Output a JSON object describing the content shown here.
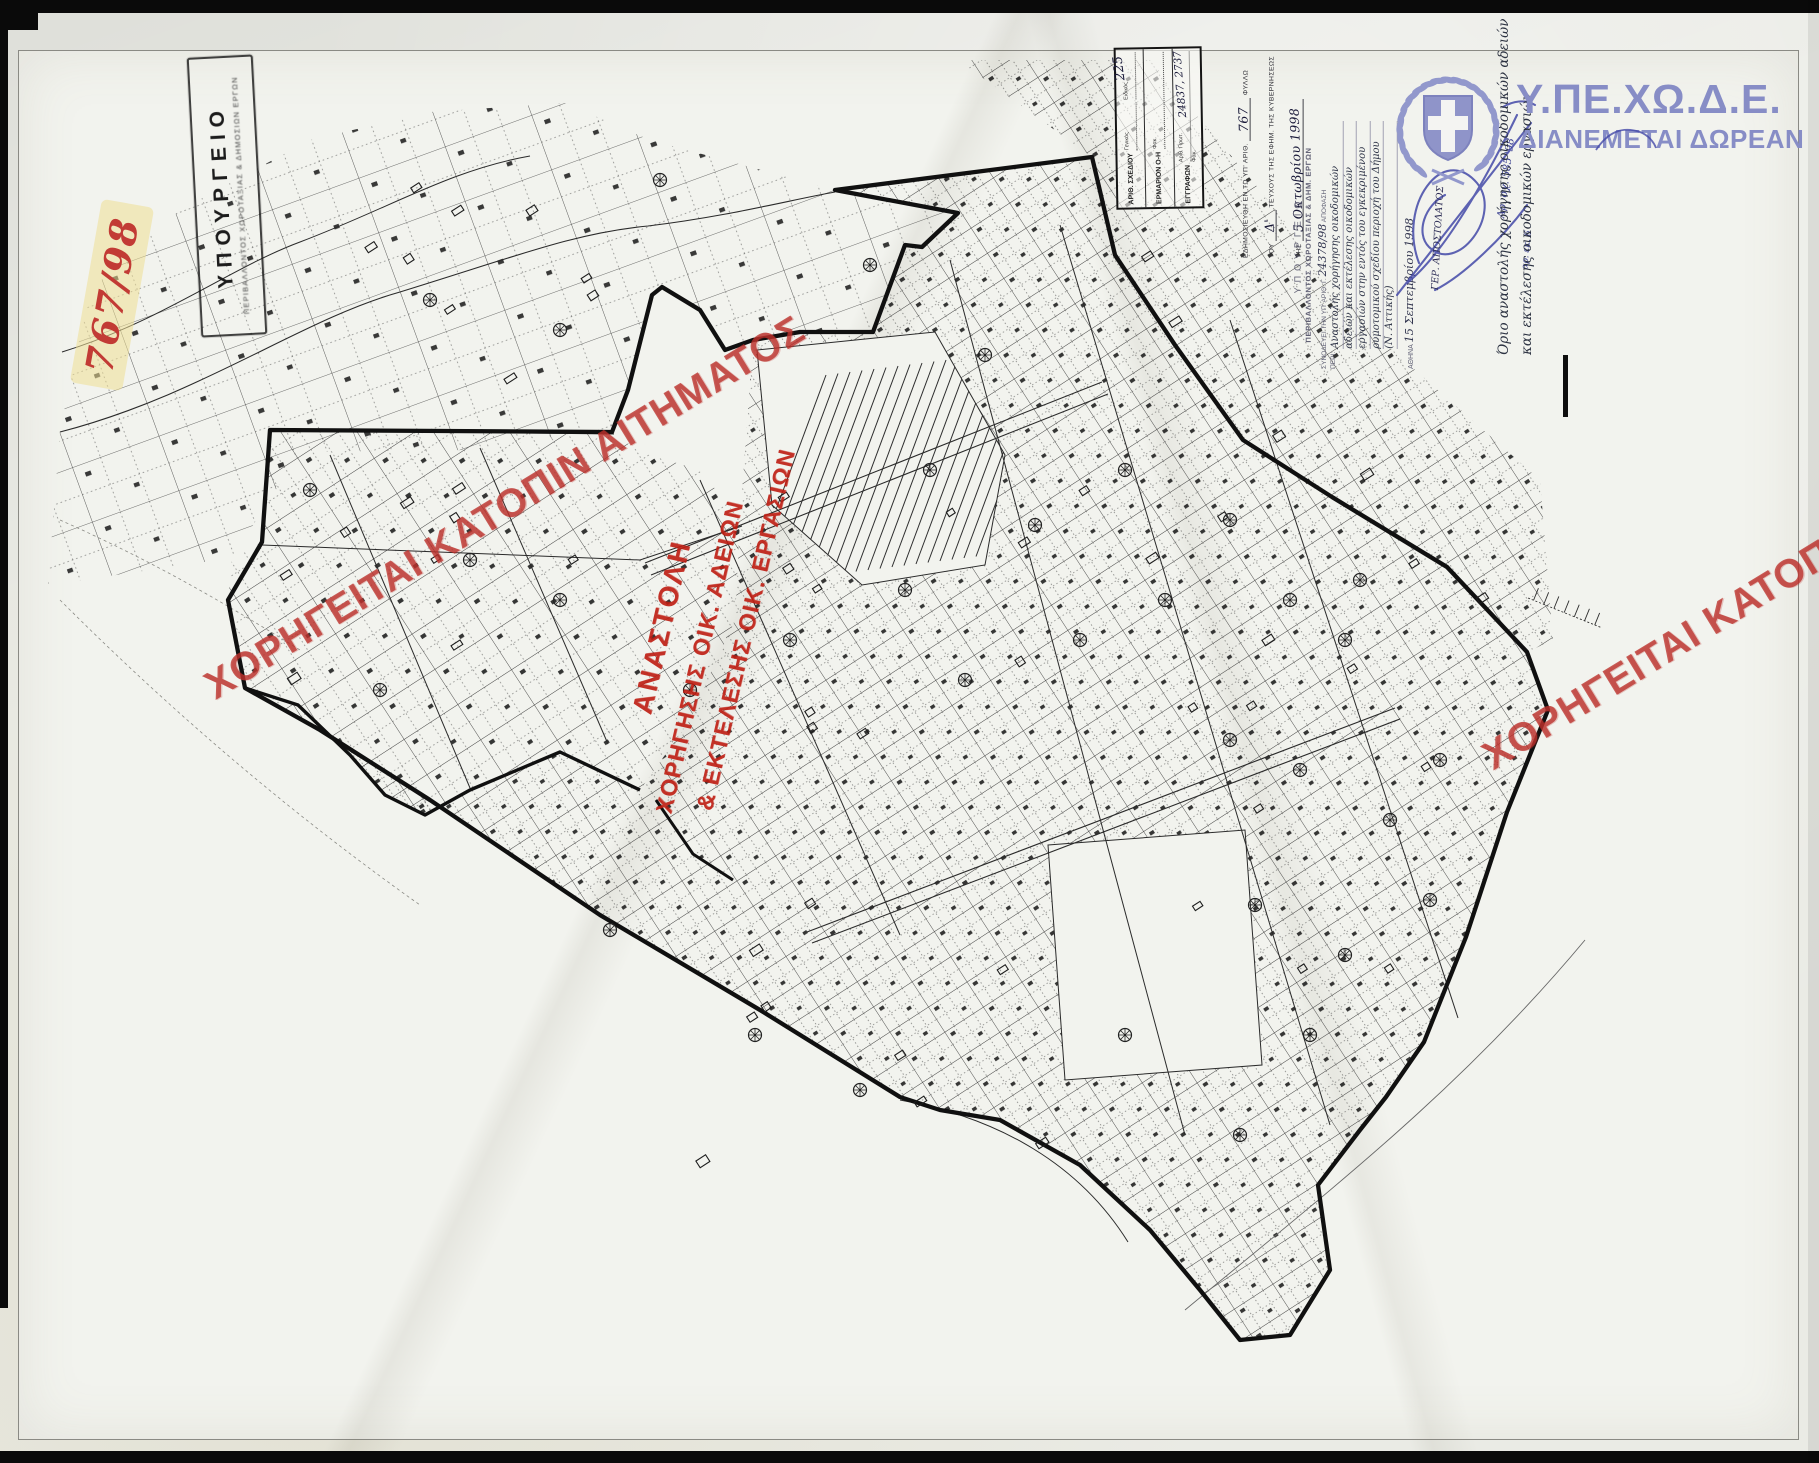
{
  "colors": {
    "watermark_red": "#bb302a",
    "stamp_red": "#bf1d12",
    "ink_blue": "#4449a8",
    "logo_violet": "#878dc6",
    "paper": "#f2f3ee",
    "map_line": "#222222"
  },
  "corner_number": "767/98",
  "top_left_stamp": {
    "line1": "ΥΠΟΥΡΓΕΙΟ",
    "line2": "ΠΕΡΙΒΑΛΛΟΝΤΟΣ ΧΩΡΟΤΑΞΙΑΣ & ΔΗΜΟΣΙΩΝ ΕΡΓΩΝ"
  },
  "filing_box": {
    "row1_label": "ΑΡΙΘ. ΣΧΕΔΙΟΥ",
    "row1_sub1": "Γενικός",
    "row1_sub2": "Ειδικός",
    "row2_label": "ΕΡΜΑΡΙΟΝ Ο-Η",
    "row2_sub": "Φακ.",
    "row2_value": "225",
    "row3_label": "ΕΓΓΡΑΦΩΝ",
    "row3_sub1": "Αριθ. Πρωτ.",
    "row3_value": "24837, 2737",
    "row3_sub2": "Φακ."
  },
  "gazette_note": {
    "l1a": "ΕΔΗΜΟΣΙΕΥΘΗ ΕΝ ΤΩ ΥΠ' ΑΡΙΘ.",
    "l1_value": "767",
    "l1b": "ΦΥΛΛΩ",
    "l2a": "ΤΟΥ",
    "l2_value": "Δ'",
    "l2b": "ΤΕΥΧΟΥΣ ΤΗΣ ΕΦΗΜ. ΤΗΣ ΚΥΒΕΡΝΗΣΕΩΣ",
    "l3a": "ΤΗΣ",
    "l3_value": "5 Οκτωβρίου 1998"
  },
  "decision_stamp": {
    "title": "ΥΠΟΥΡΓΕΙΟ",
    "subtitle": "ΠΕΡΙΒΑΛΛΟΝΤΟΣ ΧΩΡΟΤΑΞΙΑΣ & ΔΗΜ. ΕΡΓΩΝ",
    "ref_a": "ΣΥΝΟΔΕΥΕΙ ΤΗΝ ΥΠ' ΑΡΙΘ. Γ.",
    "ref_value": "24378/98",
    "ref_b": "ΑΠΟΦΑΣΗ",
    "peri_label": "ΠΕΡΙ:",
    "peri1": "Αναστολής χορήγησης οικοδομικών",
    "peri2": "αδειών και εκτέλεσης οικοδομικών",
    "peri3": "εργασιών στην εντός του εγκεκριμένου",
    "peri4": "ρυμοτομικού σχεδίου περιοχή του Δήμου",
    "peri5": "(Ν. Αττικής)",
    "place": "ΑΘΗΝΑ",
    "date_value": "15 Σεπτεμβρίου 1998",
    "signer": "ΓΕΡ. ΑΠΟΣΤΟΛΑΤΟΣ"
  },
  "margin_notes": {
    "legend1": "Όριο αναστολής χορήγησης οικοδομικών αδειών",
    "legend2": "και εκτέλεσης οικοδομικών εργασιών",
    "sketch_no": "Αρ. σχ. 585 '98",
    "extra": "αρ. εκ. 6"
  },
  "agency": {
    "acronym": "Υ.ΠΕ.ΧΩ.Δ.Ε.",
    "distribution": "ΔΙΑΝΕΜΕΤΑΙ ΔΩΡΕΑΝ"
  },
  "red_stamp": {
    "line1": "ΑΝΑΣΤΟΛΗ",
    "line2": "ΧΟΡΗΓΗΣΗΣ ΟΙΚ. ΑΔΕΙΩΝ",
    "line3": "& ΕΚΤΕΛΕΣΗΣ ΟΙΚ. ΕΡΓΑΣΙΩΝ"
  },
  "watermark": {
    "full": "ΧΟΡΗΓΕΙΤΑΙ ΚΑΤΟΠΙΝ ΑΙΤΗΜΑΤΟΣ",
    "partial": "ΧΟΡΗΓΕΙΤΑΙ ΚΑΤΟΠ"
  }
}
